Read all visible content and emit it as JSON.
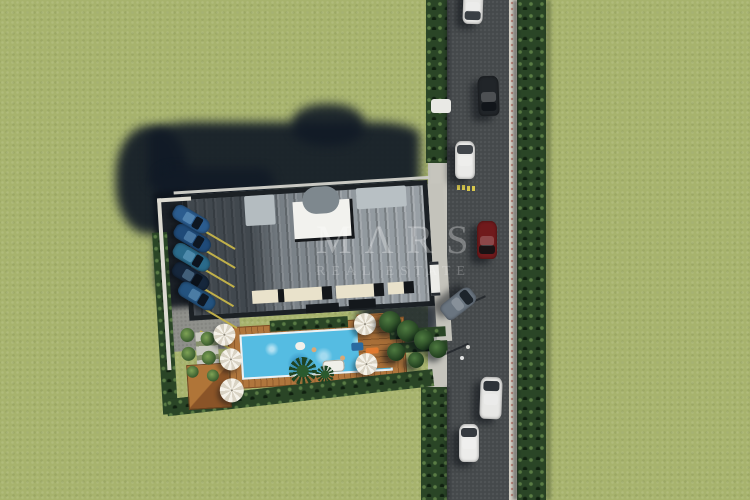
{
  "watermark": {
    "brand": "MΛRS",
    "tagline": "REAL ESTATE"
  },
  "palette": {
    "grass": "#a7b36d",
    "asphalt": "#45494b",
    "hedge": "#2a4526",
    "roof": "#8b9399",
    "roof_frame": "#1c2125",
    "skylight": "#f2f2ee",
    "terrace": "#e9e2cb",
    "pool_water": "#55bce2",
    "deck_wood": "#b0763d",
    "shadow": "#111a26",
    "curb": "#d6d2c7",
    "parking_line": "#c0b04a"
  },
  "shadows": {
    "blobs": [
      {
        "name": "building-shadow-west-lobe",
        "x": 116,
        "y": 126,
        "w": 72,
        "h": 108,
        "br": 45,
        "o": 0.92
      },
      {
        "name": "building-shadow-north-band",
        "x": 148,
        "y": 122,
        "w": 272,
        "h": 72,
        "br": 18,
        "o": 0.92
      },
      {
        "name": "building-shadow-dome-bump",
        "x": 292,
        "y": 104,
        "w": 72,
        "h": 42,
        "br": 45,
        "o": 0.9
      },
      {
        "name": "parking-shadow-area",
        "x": 156,
        "y": 168,
        "w": 118,
        "h": 128,
        "br": 12,
        "o": 0.88
      },
      {
        "name": "entrance-trees-shadow",
        "x": 358,
        "y": 296,
        "w": 82,
        "h": 48,
        "br": 40,
        "o": 0.8
      }
    ]
  },
  "road": {
    "markings": {
      "yellow_dashes": [
        {
          "name": "yellow-dash",
          "x": 457,
          "y": 185
        },
        {
          "name": "yellow-dash",
          "x": 462,
          "y": 185
        },
        {
          "name": "yellow-dash",
          "x": 467,
          "y": 186
        },
        {
          "name": "yellow-dash",
          "x": 472,
          "y": 186
        }
      ],
      "dots": [
        {
          "name": "road-dot",
          "x": 460,
          "y": 356
        }
      ],
      "pole_shadows": [
        {
          "name": "pole-shadow",
          "x": 459,
          "y": 307,
          "len": 29,
          "rot": -24
        },
        {
          "name": "pole-shadow",
          "x": 441,
          "y": 355,
          "len": 30,
          "rot": -24
        }
      ]
    },
    "cars": [
      {
        "name": "car-white-top-edge",
        "x": 463,
        "y": -12,
        "w": 20,
        "h": 36,
        "rot": 2,
        "body": "#e8e8e6",
        "glass": "#3a3f44",
        "ws": 1
      },
      {
        "name": "car-black-southbound",
        "x": 478,
        "y": 76,
        "w": 21,
        "h": 40,
        "rot": -2,
        "body": "#212529",
        "glass": "#11151a",
        "ws": 1
      },
      {
        "name": "car-white-northbound",
        "x": 455,
        "y": 141,
        "w": 20,
        "h": 38,
        "rot": 0,
        "body": "#eaeae8",
        "glass": "#40454a",
        "ws": 0
      },
      {
        "name": "car-red-southbound",
        "x": 477,
        "y": 221,
        "w": 20,
        "h": 38,
        "rot": 0,
        "body": "#701a1c",
        "glass": "#1a1214",
        "ws": 1
      },
      {
        "name": "car-silver-exiting-driveway",
        "x": 449,
        "y": 285,
        "w": 19,
        "h": 37,
        "rot": 52,
        "body": "#6a7580",
        "glass": "#1d242b",
        "ws": 0
      },
      {
        "name": "van-white-northbound",
        "x": 480,
        "y": 377,
        "w": 22,
        "h": 42,
        "rot": 2,
        "body": "#e7e7e5",
        "glass": "#2f343a",
        "ws": 0
      },
      {
        "name": "car-white-northbound-2",
        "x": 459,
        "y": 424,
        "w": 20,
        "h": 38,
        "rot": 0,
        "body": "#ececea",
        "glass": "#353a3f",
        "ws": 0
      }
    ],
    "misc": [
      {
        "name": "utility-box-white",
        "x": 431,
        "y": 99,
        "w": 20,
        "h": 14,
        "c": "#e9e9e5",
        "br": 3,
        "z": 3
      },
      {
        "name": "pole-base",
        "x": 466,
        "y": 345,
        "w": 4,
        "h": 4,
        "c": "#dcdcd8",
        "br": 2,
        "z": 3
      }
    ]
  },
  "parking": {
    "cars": [
      {
        "name": "parked-car-blue-1",
        "x": 26,
        "y": 27,
        "w": 40,
        "h": 16,
        "rot": 34,
        "body": "#2b5c8f",
        "glass": "#0e1722"
      },
      {
        "name": "parked-car-blue-2",
        "x": 26,
        "y": 46,
        "w": 40,
        "h": 16,
        "rot": 34,
        "body": "#1f4a78",
        "glass": "#0e1722"
      },
      {
        "name": "parked-car-teal-3",
        "x": 24,
        "y": 65,
        "w": 40,
        "h": 16,
        "rot": 34,
        "body": "#2a6a8a",
        "glass": "#0c141e"
      },
      {
        "name": "parked-car-navy-4",
        "x": 22,
        "y": 84,
        "w": 40,
        "h": 16,
        "rot": 34,
        "body": "#16273c",
        "glass": "#0a111a"
      },
      {
        "name": "parked-car-blue-5",
        "x": 27,
        "y": 104,
        "w": 40,
        "h": 16,
        "rot": 34,
        "body": "#24537f",
        "glass": "#0e1722"
      }
    ],
    "lines": [
      {
        "name": "stall-line",
        "x": 58,
        "y": 46,
        "len": 36,
        "rot": 34
      },
      {
        "name": "stall-line",
        "x": 57,
        "y": 65,
        "len": 36,
        "rot": 34
      },
      {
        "name": "stall-line",
        "x": 55,
        "y": 84,
        "len": 36,
        "rot": 34
      },
      {
        "name": "stall-line",
        "x": 53,
        "y": 103,
        "len": 36,
        "rot": 34
      },
      {
        "name": "stall-line",
        "x": 55,
        "y": 125,
        "len": 36,
        "rot": 34
      },
      {
        "name": "stall-line",
        "x": 48,
        "y": 146,
        "len": 36,
        "rot": 34
      }
    ]
  },
  "property": {
    "building": {
      "units": [
        {
          "name": "rooftop-unit-left",
          "x": 100,
          "y": 15,
          "w": 30,
          "h": 30,
          "c": "#b4bcc0",
          "br": 2,
          "z": 5
        },
        {
          "name": "rooftop-dome",
          "x": 158,
          "y": 10,
          "w": 37,
          "h": 27,
          "c": "#7e888e",
          "br": 14,
          "z": 5
        },
        {
          "name": "rooftop-unit-right",
          "x": 212,
          "y": 14,
          "w": 50,
          "h": 21,
          "c": "#b8c0c4",
          "br": 2,
          "z": 5
        }
      ],
      "terraces": [
        {
          "name": "terrace",
          "x": 102,
          "y": 110,
          "w": 26,
          "h": 13
        },
        {
          "name": "terrace",
          "x": 134,
          "y": 110,
          "w": 38,
          "h": 13
        },
        {
          "name": "terrace",
          "x": 186,
          "y": 110,
          "w": 38,
          "h": 13
        },
        {
          "name": "terrace",
          "x": 238,
          "y": 110,
          "w": 16,
          "h": 12
        }
      ],
      "notches": [
        {
          "name": "roof-notch",
          "x": 155,
          "y": 127,
          "w": 33,
          "h": 9,
          "c": "#14181c",
          "z": 5
        },
        {
          "name": "roof-notch",
          "x": 198,
          "y": 125,
          "w": 27,
          "h": 9,
          "c": "#14181c",
          "z": 5
        }
      ]
    },
    "pool": {
      "floats": [
        {
          "name": "pool-float-ring",
          "x": 142,
          "y": 164,
          "w": 10,
          "h": 8,
          "c": "#f2f0ea",
          "br": 5,
          "z": 6
        },
        {
          "name": "pool-float-mat-blue",
          "x": 198,
          "y": 168,
          "w": 12,
          "h": 8,
          "c": "#2a6aa0",
          "br": 2,
          "z": 6
        },
        {
          "name": "pool-float-mat-orange",
          "x": 212,
          "y": 174,
          "w": 13,
          "h": 6,
          "c": "#e07a30",
          "br": 2,
          "z": 6
        },
        {
          "name": "swimmer",
          "x": 158,
          "y": 170,
          "w": 5,
          "h": 5,
          "c": "#d8a878",
          "br": 3,
          "z": 6
        },
        {
          "name": "swimmer",
          "x": 186,
          "y": 180,
          "w": 5,
          "h": 5,
          "c": "#d8a878",
          "br": 3,
          "z": 6
        }
      ]
    },
    "garden": {
      "umbrellas": [
        {
          "name": "umbrella",
          "x": 72,
          "y": 152,
          "r": 11
        },
        {
          "name": "umbrella",
          "x": 77,
          "y": 177,
          "r": 11
        },
        {
          "name": "umbrella",
          "x": 76,
          "y": 208,
          "r": 12
        },
        {
          "name": "umbrella",
          "x": 213,
          "y": 150,
          "r": 11
        },
        {
          "name": "umbrella",
          "x": 212,
          "y": 190,
          "r": 11
        }
      ],
      "shrubs": [
        {
          "name": "garden-shrub",
          "x": 35,
          "y": 150,
          "r": 7
        },
        {
          "name": "garden-shrub",
          "x": 55,
          "y": 155,
          "r": 7
        },
        {
          "name": "garden-shrub",
          "x": 35,
          "y": 169,
          "r": 7
        },
        {
          "name": "garden-shrub",
          "x": 55,
          "y": 174,
          "r": 7
        },
        {
          "name": "garden-shrub",
          "x": 38,
          "y": 187,
          "r": 6
        },
        {
          "name": "garden-shrub",
          "x": 58,
          "y": 192,
          "r": 6
        }
      ],
      "palms": [
        {
          "name": "palm-tree",
          "x": 148,
          "y": 193,
          "r": 14
        },
        {
          "name": "palm-tree",
          "x": 170,
          "y": 198,
          "r": 9
        }
      ]
    },
    "entrance": {
      "trees": [
        {
          "name": "entrance-tree",
          "x": 390,
          "y": 322,
          "r": 11
        },
        {
          "name": "entrance-tree",
          "x": 408,
          "y": 331,
          "r": 11
        },
        {
          "name": "entrance-tree",
          "x": 424,
          "y": 340,
          "r": 10
        },
        {
          "name": "entrance-tree",
          "x": 438,
          "y": 349,
          "r": 9
        },
        {
          "name": "entrance-tree",
          "x": 396,
          "y": 352,
          "r": 9
        },
        {
          "name": "entrance-tree",
          "x": 416,
          "y": 360,
          "r": 8
        }
      ]
    }
  }
}
